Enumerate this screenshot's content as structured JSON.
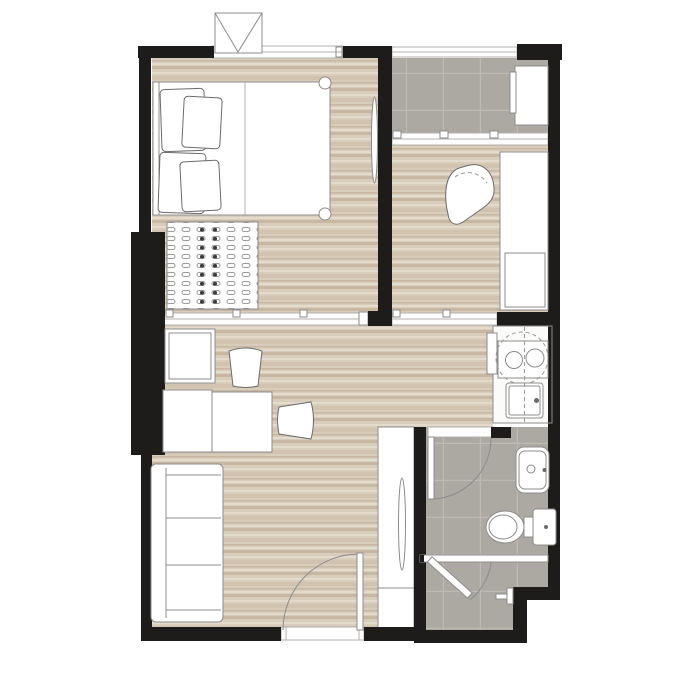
{
  "plan": {
    "label": "studio-apartment-floor-plan"
  },
  "rooms": {
    "bedroom": "bedroom",
    "balcony": "balcony",
    "study": "multipurpose-room",
    "living": "living-dining-area",
    "kitchen": "kitchenette",
    "bathroom": "bathroom",
    "wardrobe": "wardrobe",
    "entry": "entry-door"
  },
  "fixtures": {
    "bed": "double-bed",
    "sofa": "sofa",
    "table": "dining-table",
    "stove": "two-burner-stove",
    "sink": "kitchen-sink",
    "basin": "bathroom-basin",
    "toilet": "toilet",
    "shower": "shower",
    "ac": "ac-condenser-unit",
    "washer": "balcony-unit"
  },
  "colors": {
    "wall": "#1d1c1a",
    "wood-base": "#d8ccbb",
    "wood-dark": "#c8b8a3",
    "wood-mid": "#d1c3b0",
    "wood-light": "#e4dbcd",
    "tile": "#aca8a2",
    "tile-line": "#bdb9b3",
    "outline": "#8c8c8c",
    "outline-light": "#b5b2ae",
    "outline-dark": "#6b6b6b",
    "dash": "#9a9a9a"
  }
}
